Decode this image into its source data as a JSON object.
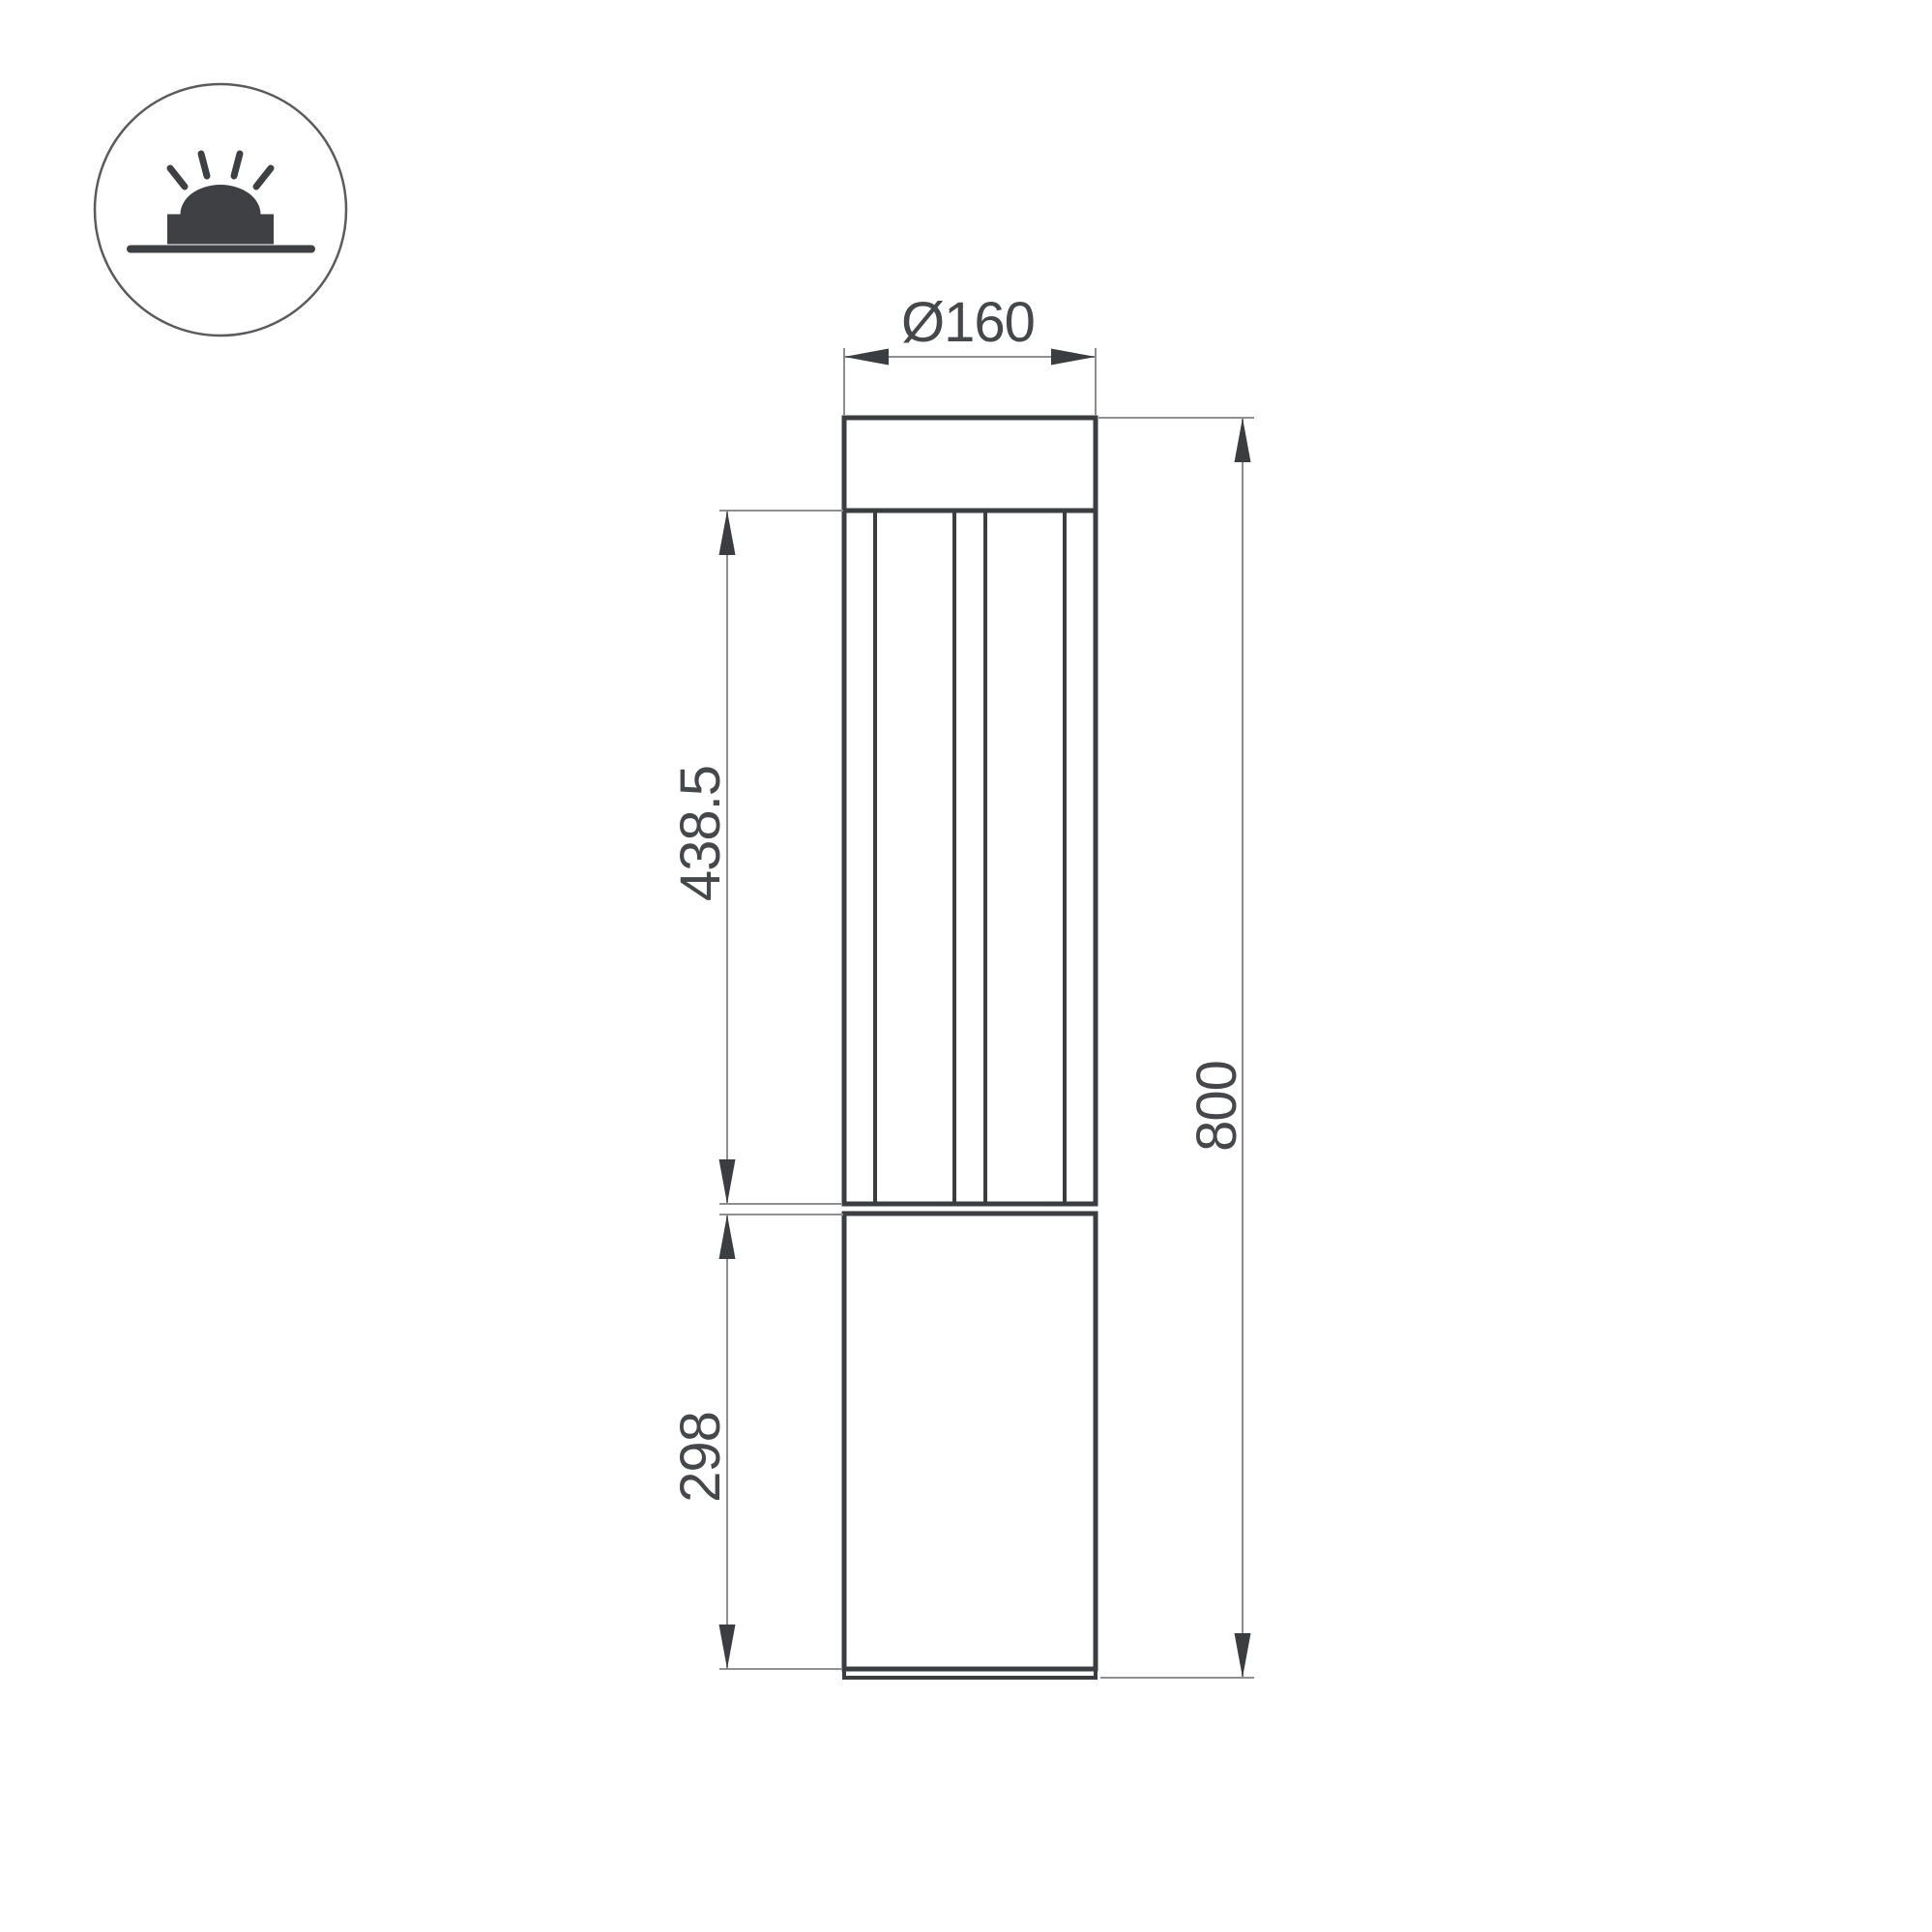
{
  "drawing": {
    "kind": "technical-dimension-drawing",
    "subject": "bollard-luminaire-front-view",
    "sections": {
      "top_cap": "lamp head cap",
      "lamp_section": "louvered light section",
      "body_section": "lower pole body",
      "base_plate": "ground base plate"
    }
  },
  "icon": {
    "name": "surface-mounted-light-badge",
    "parts": [
      "light-rays",
      "light-dome",
      "mounting-base",
      "ground-line"
    ]
  },
  "dimensions": {
    "diameter": {
      "label": "Ø160",
      "value": 160,
      "orientation": "horizontal"
    },
    "lamp_section_height": {
      "label": "438.5",
      "value": 438.5,
      "orientation": "vertical"
    },
    "body_section_height": {
      "label": "298",
      "value": 298,
      "orientation": "vertical"
    },
    "overall_height": {
      "label": "800",
      "value": 800,
      "orientation": "vertical"
    }
  },
  "colors": {
    "background": "#ffffff",
    "outline": "#3b3d40",
    "dimension_line": "#8f8f8f",
    "text": "#45474a",
    "icon_circle_stroke": "#595b5e"
  }
}
